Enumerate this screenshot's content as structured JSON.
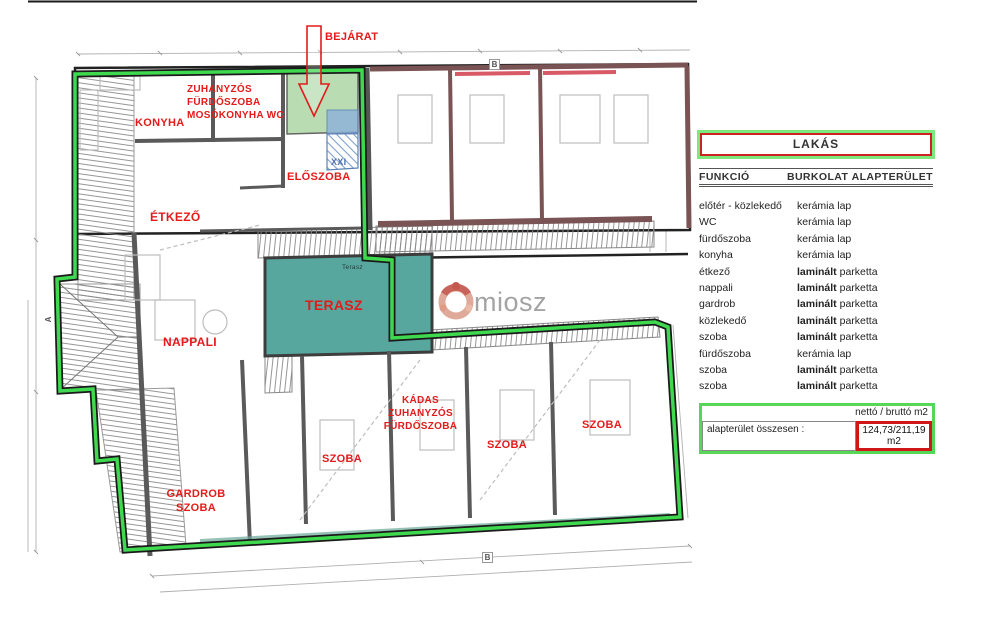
{
  "plan": {
    "labels": {
      "bejarat": "BEJÁRAT",
      "bathroom_top": "ZUHANYZÓS\nFÜRDŐSZOBA\nMOSÓKONYHA WC",
      "konyha": "KONYHA",
      "eloszoba": "ELŐSZOBA",
      "etkezo": "ÉTKEZŐ",
      "terasz": "TERASZ",
      "terasz_small": "Terasz",
      "nappali": "NAPPALI",
      "kadas_bathroom": "KÁDAS\nZUHANYZÓS\nFÜRDŐSZOBA",
      "szoba_left": "SZOBA",
      "szoba_mid": "SZOBA",
      "szoba_right": "SZOBA",
      "gardrob": "GARDROB\nSZOBA",
      "stair": "XXI"
    },
    "markers": {
      "section_b_top": "B",
      "section_b_bottom": "B",
      "section_a_left": "A"
    }
  },
  "watermark": {
    "text": "miosz"
  },
  "panel": {
    "title": "LAKÁS",
    "columns": {
      "funkcio": "FUNKCIÓ",
      "burkolat": "BURKOLAT",
      "alapterulet": "ALAPTERÜLET"
    },
    "rows": [
      {
        "funkcio": "előtér - közlekedő",
        "burkolat": "kerámia lap"
      },
      {
        "funkcio": "WC",
        "burkolat": "kerámia lap"
      },
      {
        "funkcio": "fürdőszoba",
        "burkolat": "kerámia lap"
      },
      {
        "funkcio": "konyha",
        "burkolat": "kerámia lap"
      },
      {
        "funkcio": "étkező",
        "burkolat": "laminált parketta"
      },
      {
        "funkcio": "nappali",
        "burkolat": "laminált parketta"
      },
      {
        "funkcio": "gardrob",
        "burkolat": "laminált parketta"
      },
      {
        "funkcio": "közlekedő",
        "burkolat": "laminált parketta"
      },
      {
        "funkcio": "szoba",
        "burkolat": "laminált parketta"
      },
      {
        "funkcio": "fürdőszoba",
        "burkolat": "kerámia lap"
      },
      {
        "funkcio": "szoba",
        "burkolat": "laminált parketta"
      },
      {
        "funkcio": "szoba",
        "burkolat": "laminált parketta"
      }
    ],
    "summary": {
      "net_gross": "nettó / bruttó m2",
      "total_label": "alapterület összesen  :",
      "total_value": "124,73/211,19 m2"
    }
  },
  "colors": {
    "highlight_green": "#3fd94f",
    "entrance_green": "#b9dcb2",
    "terrace_teal": "#57a79f",
    "label_red": "#e31b1b",
    "wall_maroon": "#7a5454",
    "accent_pink": "#d85a66",
    "stair_blue": "#8fb3d9"
  }
}
